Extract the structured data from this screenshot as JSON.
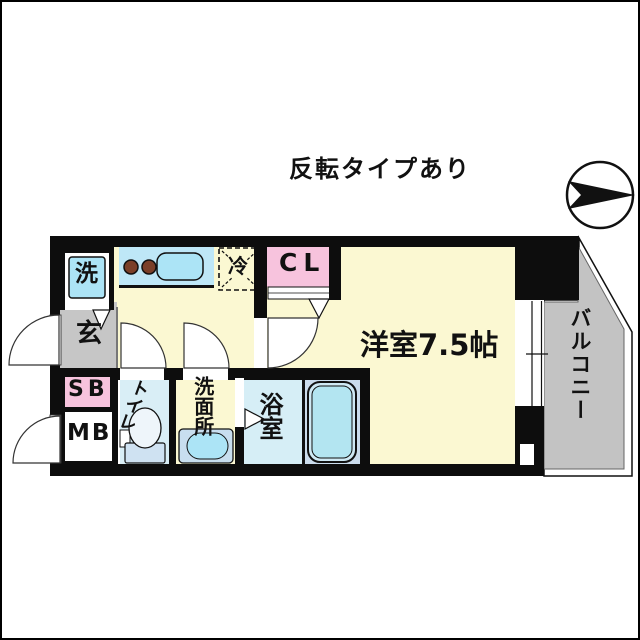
{
  "page": {
    "title": "反転タイプあり"
  },
  "compass": {
    "icon": "north-arrow-right",
    "description": "circle with black arrow pointing right"
  },
  "floorplan": {
    "labels": {
      "washer": "洗",
      "entrance": "玄",
      "shoe_box": "SB",
      "meter_box": "MB",
      "toilet": "トイレ",
      "washroom": "洗面所",
      "bathroom": "浴室",
      "fridge": "冷",
      "closet": "CL",
      "main_room": "洋室7.5帖",
      "balcony": "バルコニー"
    },
    "colors": {
      "floor_yellow": "#fbf8d2",
      "water_blue": "#bee7f7",
      "fixture_cyan": "#ace4f6",
      "accent_pink": "#f7c3dd",
      "concrete_gray": "#c6c6c6",
      "balcony_gray": "#c3c3c3",
      "toilet_blue": "#d9eef6",
      "bath_blue": "#d6eef6",
      "platform_blue": "#cbdcec",
      "basin_blue": "#c8deef",
      "tub_rim_blue": "#cfe9f4",
      "tub_blue": "#b3e5f1",
      "toilet_tank_blue": "#cfe2f2",
      "burner_brown": "#7b3f28",
      "wall_black": "#0d0d0d"
    }
  }
}
